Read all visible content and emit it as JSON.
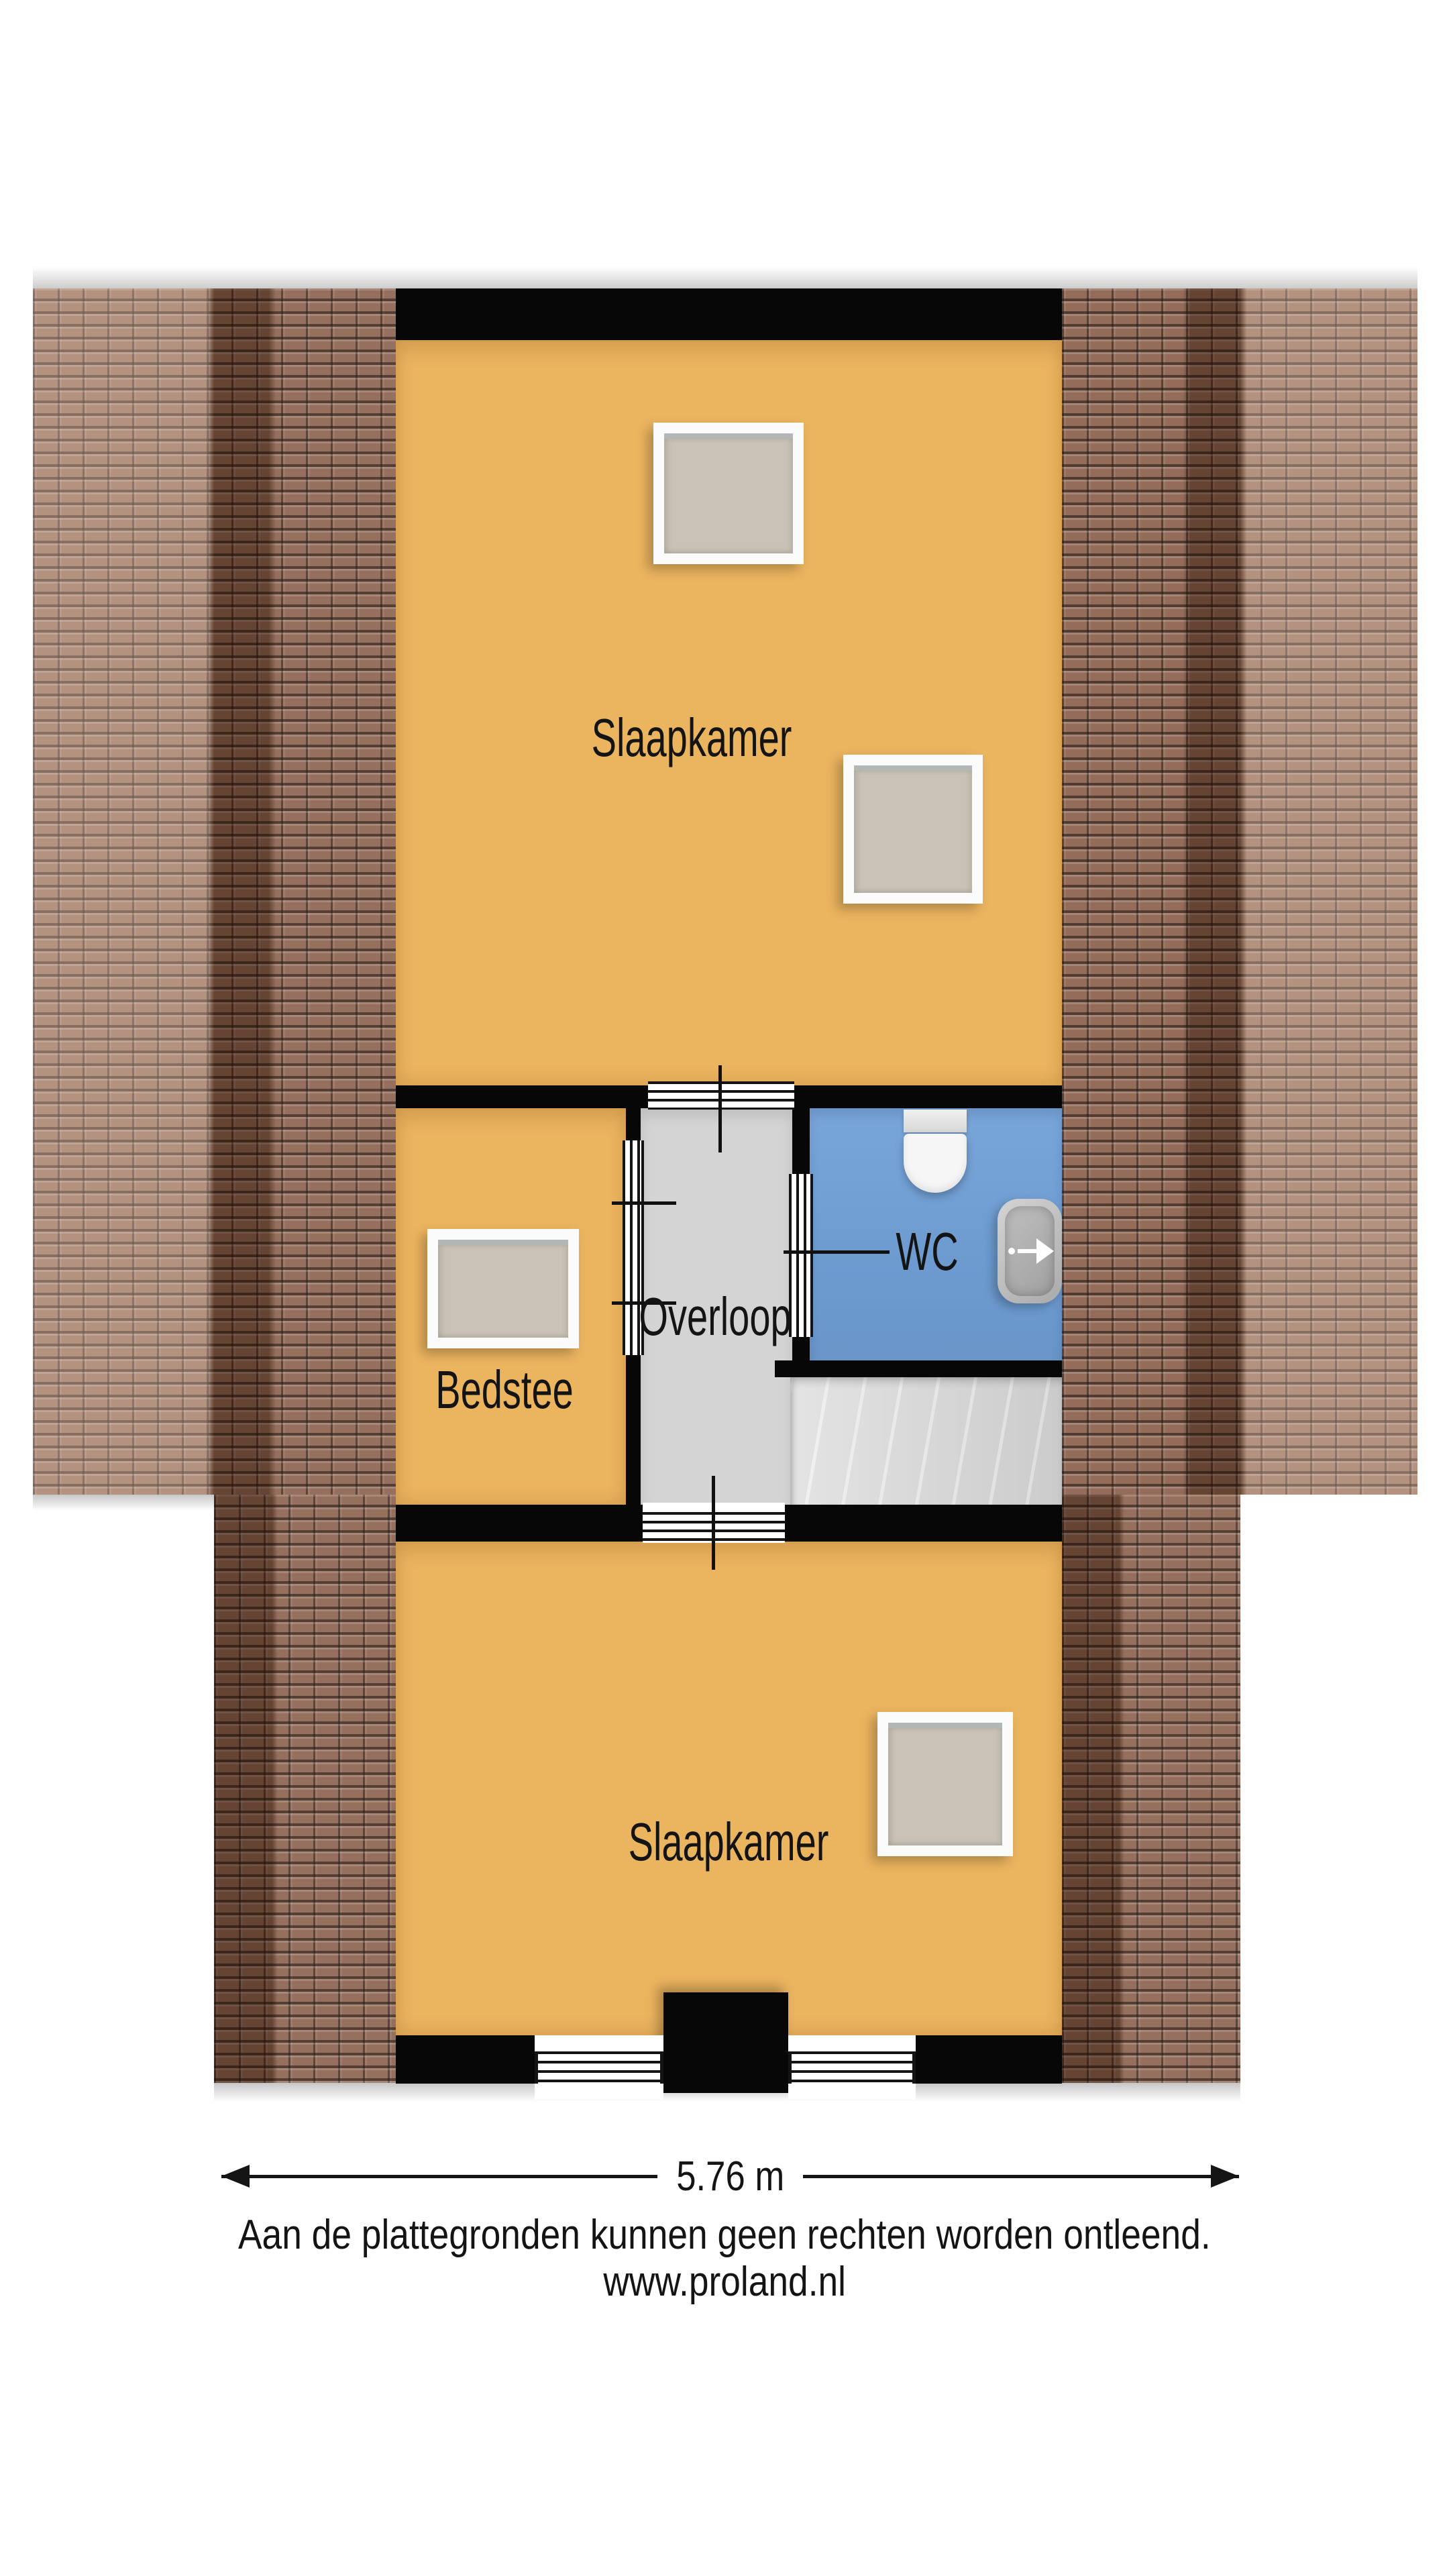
{
  "plan": {
    "type": "floorplan-top-down",
    "rooms": {
      "slaapkamer_top": {
        "label": "Slaapkamer"
      },
      "bedstee": {
        "label": "Bedstee"
      },
      "overloop": {
        "label": "Overloop"
      },
      "wc": {
        "label": "WC"
      },
      "slaapkamer_bottom": {
        "label": "Slaapkamer"
      }
    },
    "icons": {
      "toilet": "toilet-top-view-icon",
      "sink": "sink-top-view-icon",
      "stairs": "staircase-treads",
      "skylight": "roof-window",
      "roof": "roof-tiles"
    },
    "colors": {
      "room_fill": "#ebb45f",
      "hall_fill": "#d4d4d4",
      "stairs_fill": "#d8d8d8",
      "wc_fill": "#6d9bd0",
      "wall": "#070707",
      "roof_base": "#8d6450",
      "roof_dark_band": "#4f352a",
      "roof_light_band": "#b98f78",
      "window_glass": "#c9c2b5",
      "window_frame": "#ffffff"
    }
  },
  "dimension": {
    "width_label": "5.76 m"
  },
  "footer": {
    "disclaimer": "Aan de plattegronden kunnen geen rechten worden ontleend.",
    "website": "www.proland.nl"
  }
}
